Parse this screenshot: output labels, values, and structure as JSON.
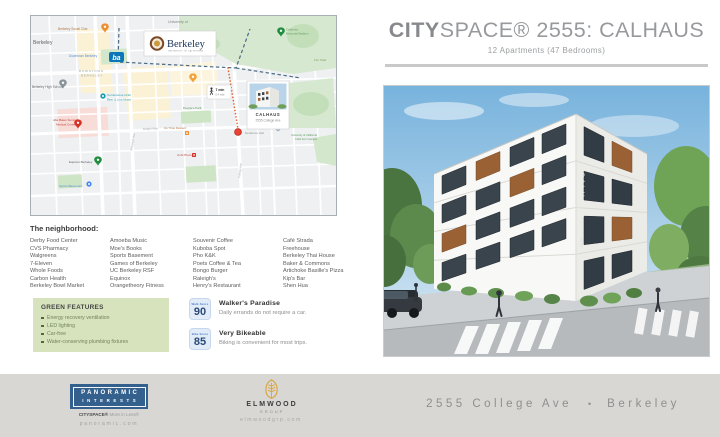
{
  "header": {
    "title_bold": "CITY",
    "title_rest": "SPACE® 2555: CALHAUS",
    "subtitle": "12 Apartments (47 Bedrooms)"
  },
  "map": {
    "labels": {
      "city": "Berkeley",
      "social_club": "Berkeley Social Club",
      "university_of": "University of",
      "downtown_link": "Downtown Berkeley",
      "downtown_caps_1": "DOWNTOWN",
      "downtown_caps_2": "BERKELEY",
      "high_school": "Berkeley High School",
      "cornerstone_1": "Cornerstone Craft",
      "cornerstone_2": "Beer & Live Music",
      "alta_bates_1": "Alta Bates Summit",
      "alta_bates_2": "Medical Center",
      "equinox": "Equinox Berkeley",
      "sports_basement": "Sports Basement",
      "peoples_park": "People's Park",
      "us_time": "Us Time Dessert",
      "cos_photo": "CoS Photo",
      "stadium_1": "California",
      "stadium_2": "Memorial Stadium",
      "fire_trails": "Fire Trails",
      "clark_kerr_1": "University of California",
      "clark_kerr_2": "Clark Kerr Campus",
      "residence_hall": "Residence Hall",
      "street_telegraph": "Telegraph Ave",
      "street_college": "College Ave",
      "street_dwight": "Dwight Way"
    },
    "university_logo": {
      "name": "Berkeley",
      "sub": "UNIVERSITY OF CALIFORNIA"
    },
    "bart": "ba",
    "walk_badge": {
      "time": "7 min",
      "distance": "0.4 mile"
    },
    "callout": {
      "title": "CALHAUS",
      "subtitle": "2555 College Ave"
    }
  },
  "neighborhood": {
    "heading": "The neighborhood:",
    "columns": [
      [
        "Derby Food Center",
        "CVS Pharmacy",
        "Walgreens",
        "7-Eleven",
        "Whole Foods",
        "Carbon Health",
        "Berkeley Bowl Market"
      ],
      [
        "Amoeba Music",
        "Moe's Books",
        "Sports Basement",
        "Games of Berkeley",
        "UC Berkeley RSF",
        "Equinox",
        "Orangetheory Fitness"
      ],
      [
        "Souvenir Coffee",
        "Kuboba Spot",
        "Pho K&K",
        "Poets Coffee & Tea",
        "Bongo Burger",
        "Raleigh's",
        "Henry's Restaurant"
      ],
      [
        "Café Strada",
        "Freehouse",
        "Berkeley Thai House",
        "Baker & Commons",
        "Artichoke Basille's Pizza",
        "Kip's Bar",
        "Shen Hua"
      ]
    ]
  },
  "green_features": {
    "heading": "GREEN FEATURES",
    "items": [
      "Energy recovery ventilation",
      "LED lighting",
      "Car-free",
      "Water-conserving plumbing fixtures"
    ]
  },
  "scores": [
    {
      "badge_label": "Walk Score",
      "value": "90",
      "title": "Walker's Paradise",
      "desc": "Daily errands do not require a car."
    },
    {
      "badge_label": "Bike Score",
      "value": "85",
      "title": "Very Bikeable",
      "desc": "Biking is convenient for most trips."
    }
  ],
  "building": {
    "sign": "CALHAUS",
    "sign_number": "2555"
  },
  "footer": {
    "panoramic": {
      "line1": "PANORAMIC",
      "line2": "INTERESTS",
      "tagline_bold": "CITYSPACE®",
      "tagline_rest": " More in Less®",
      "url": "panoramic.com"
    },
    "elmwood": {
      "name": "ELMWOOD",
      "sub": "GROUP",
      "url": "elmwoodgrp.com"
    },
    "address": {
      "street": "2555 College Ave",
      "separator": "•",
      "city": "Berkeley"
    }
  }
}
